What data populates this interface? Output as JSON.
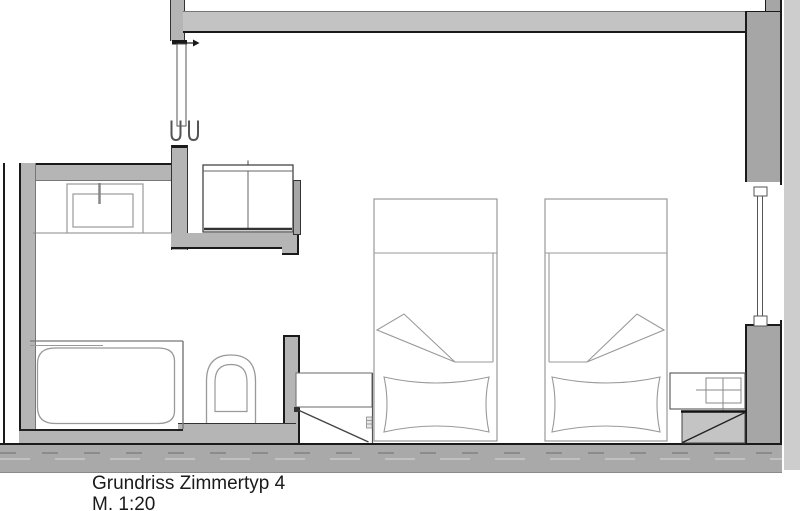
{
  "drawing": {
    "title": "Grundriss Zimmertyp 4",
    "scale": "M. 1:20"
  },
  "colors": {
    "wall": "#b5b5b5",
    "wall_dark": "#a6a6a6",
    "wall_band": "#c3c3c3",
    "exterior_strip": "#cdcdcd",
    "floor_band": "#a9a9a9",
    "shaft_fill": "#c4c4c4",
    "outline": "#1a1a1a",
    "furn": "#999999",
    "furn_dark": "#555555",
    "text": "#1a1a1a",
    "bg": "#ffffff"
  }
}
